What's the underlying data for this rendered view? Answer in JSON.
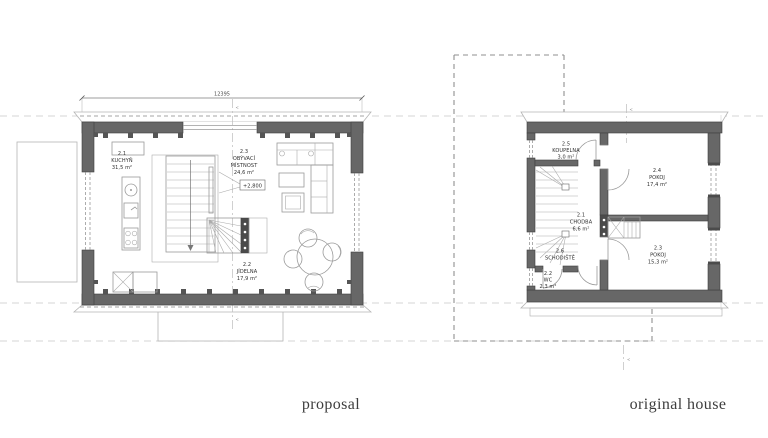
{
  "captions": {
    "left": "proposal",
    "right": "original house"
  },
  "markers": {
    "section": "<"
  },
  "proposal_plan": {
    "dimension_top": "12395",
    "level_marker": "+2,800",
    "rooms": {
      "kitchen": {
        "number": "2.1",
        "name": "KUCHYŇ",
        "area": "31,5 m²"
      },
      "living": {
        "number": "2.3",
        "name_line1": "OBÝVACÍ",
        "name_line2": "MÍSTNOST",
        "area": "24,6 m²"
      },
      "dining": {
        "number": "2.2",
        "name": "JÍDELNA",
        "area": "17,9 m²"
      }
    }
  },
  "original_plan": {
    "rooms": {
      "bathroom": {
        "number": "2.5",
        "name": "KOUPELNA",
        "area": "3,0 m²"
      },
      "room_upper": {
        "number": "2.4",
        "name": "POKOJ",
        "area": "17,4 m²"
      },
      "hallway": {
        "number": "2.1",
        "name": "CHODBA",
        "area": "6,6 m²"
      },
      "staircase": {
        "number": "2.6",
        "name": "SCHODIŠTĚ"
      },
      "wc": {
        "number": "2.2",
        "name": "WC",
        "area": "2,3 m²"
      },
      "room_lower": {
        "number": "2.3",
        "name": "POKOJ",
        "area": "15,3 m²"
      }
    }
  },
  "colors": {
    "wall": "#676767",
    "wall_dark": "#4b4b4b",
    "outline": "#3f3f3f",
    "light_line": "#b5b5b5",
    "dashed_line": "#8f8f8f",
    "reference_line": "#d4d4d4",
    "text": "#2e2e2e"
  }
}
